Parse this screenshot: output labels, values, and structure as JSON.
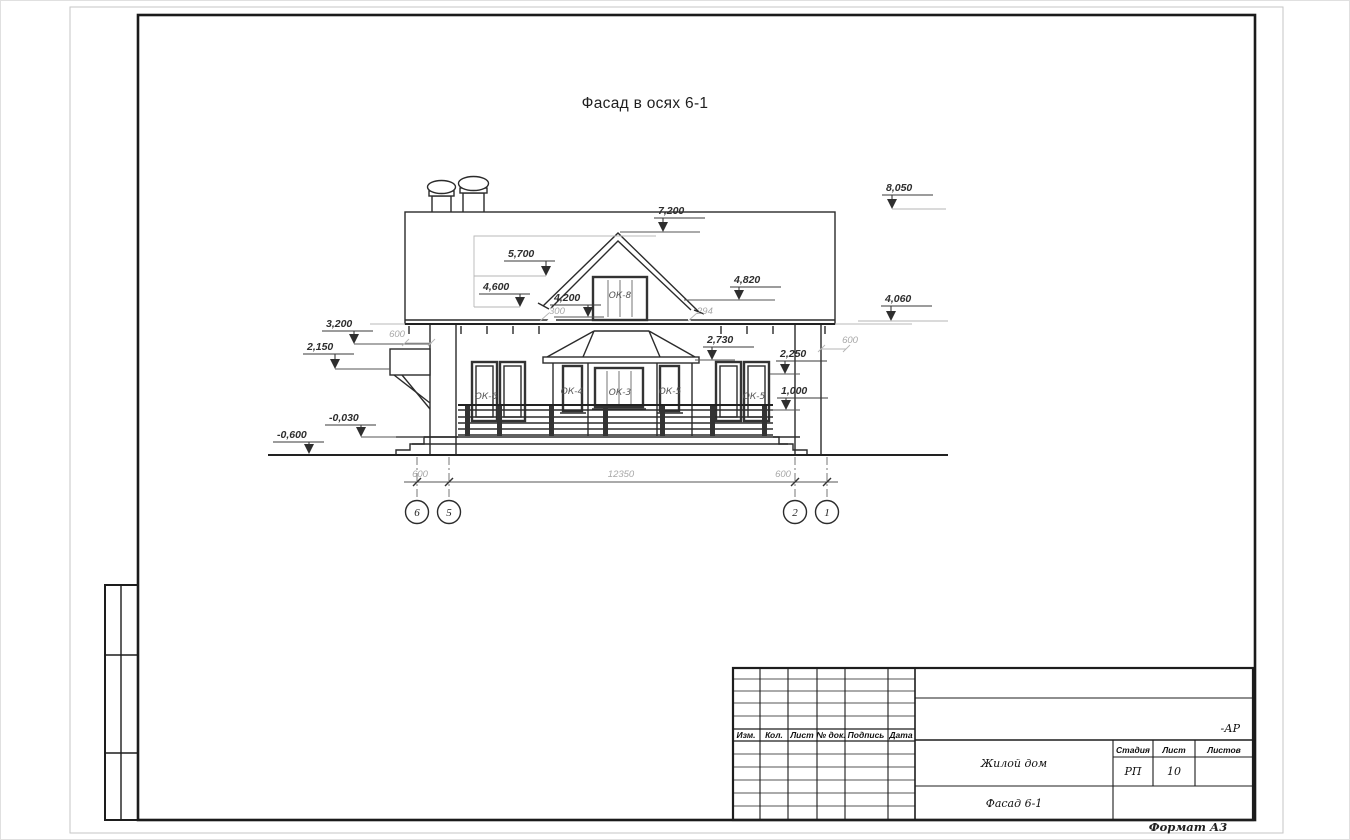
{
  "page": {
    "drawing_title": "Фасад в осях 6-1",
    "format_label": "Формат А3"
  },
  "dims": {
    "d8050": "8,050",
    "d7200": "7,200",
    "d5700": "5,700",
    "d4600": "4,600",
    "d4200": "4,200",
    "d4820": "4,820",
    "d4060": "4,060",
    "d3200": "3,200",
    "d2730": "2,730",
    "d2250": "2,250",
    "d2150": "2,150",
    "d1000": "1,000",
    "dm0030": "-0,030",
    "dm0600": "-0,600",
    "g300": "300",
    "g294": "294",
    "g600_left_eave": "600",
    "g600_right_eave": "600",
    "g600_left_axis": "600",
    "g12350": "12350",
    "g600_right_axis": "600"
  },
  "windows": {
    "ok8": "ОК-8",
    "ok6": "ОК-6",
    "ok4": "ОК-4",
    "ok3": "ОК-3",
    "ok5_bay": "ОК-5",
    "ok5_right": "ОК-5"
  },
  "axes": {
    "a6": "6",
    "a5": "5",
    "a2": "2",
    "a1": "1"
  },
  "title_block": {
    "col_izm": "Изм.",
    "col_kol": "Кол.",
    "col_list": "Лист",
    "col_ndok": "№ док.",
    "col_podpis": "Подпись",
    "col_data": "Дата",
    "code": "-АР",
    "project": "Жилой дом",
    "sheet_name": "Фасад 6-1",
    "stage_label": "Стадия",
    "list_label": "Лист",
    "listov_label": "Листов",
    "stage": "РП",
    "sheet_no": "10",
    "sheets_total": ""
  }
}
